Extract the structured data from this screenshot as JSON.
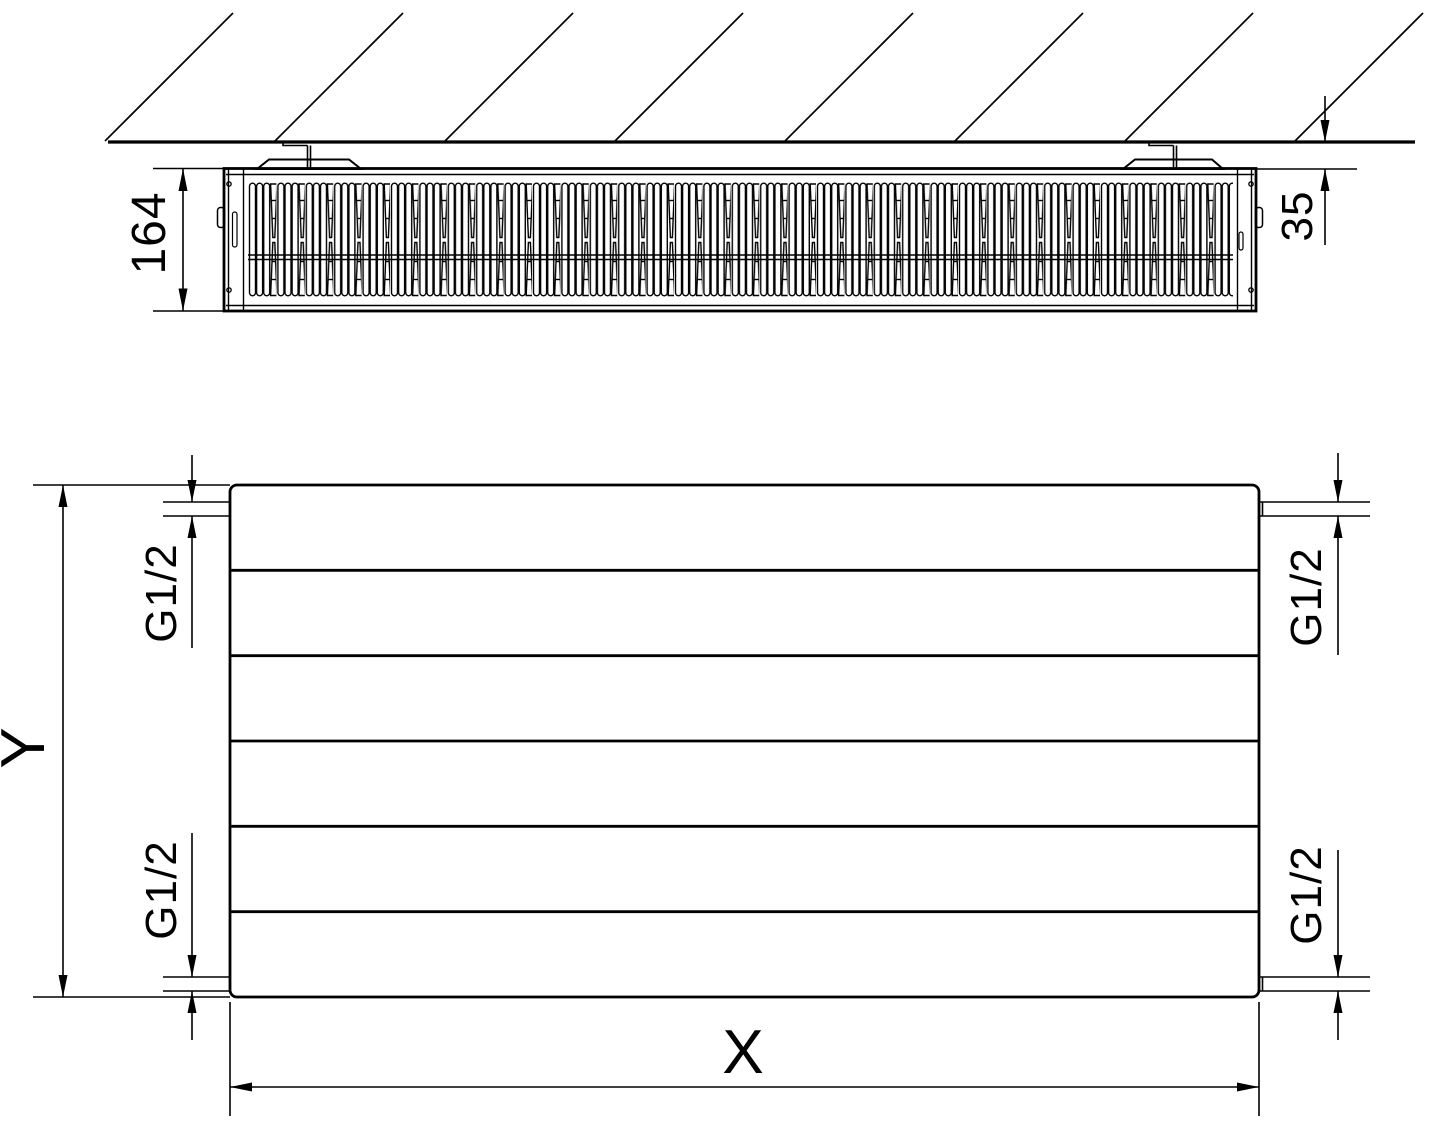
{
  "top_view": {
    "depth_dimension": "164",
    "wall_distance_dimension": "35"
  },
  "front_view": {
    "height_dimension": "Y",
    "width_dimension": "X",
    "connection_top_left": "G1/2",
    "connection_top_right": "G1/2",
    "connection_bottom_left": "G1/2",
    "connection_bottom_right": "G1/2"
  },
  "colors": {
    "line": "#000000",
    "background": "#ffffff"
  }
}
